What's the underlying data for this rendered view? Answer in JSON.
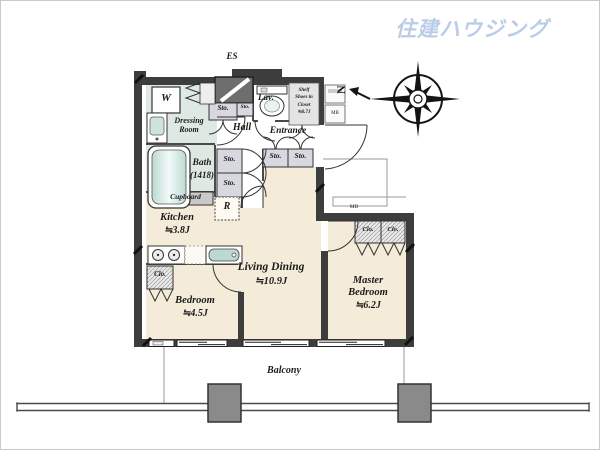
{
  "logo": {
    "text": "住建ハウジング"
  },
  "compass": {
    "north": "N"
  },
  "plan": {
    "es": "ES",
    "balcony": "Balcony",
    "mb_alcove": "MB",
    "mb_box": "MB"
  },
  "rooms": {
    "living": {
      "name": "Living Dining",
      "size": "≒10.9J"
    },
    "master": {
      "name": "Master Bedroom",
      "size": "≒6.2J"
    },
    "bedroom": {
      "name": "Bedroom",
      "size": "≒4.5J"
    },
    "kitchen": {
      "name": "Kitchen",
      "size": "≒3.8J"
    },
    "bath": {
      "name": "Bath",
      "size": "(1418)"
    },
    "dressing": {
      "name": "Dressing Room"
    },
    "hall": {
      "name": "Hall"
    },
    "entrance": {
      "name": "Entrance"
    },
    "lavatory": {
      "name": "Lav."
    }
  },
  "closets": {
    "sto": "Sto.",
    "clo": "Clo.",
    "cupboard": "Cupboard",
    "shoes": [
      "Shelf",
      "Shoes in",
      "Closet",
      "≒0.7J"
    ]
  },
  "fixtures": {
    "washer": "W",
    "fridge": "R"
  },
  "colors": {
    "wall": "#3d3d3d",
    "floor": "#f4ebd9",
    "tile": "#dfe9e3",
    "logo_blue": "#b9cce8"
  }
}
